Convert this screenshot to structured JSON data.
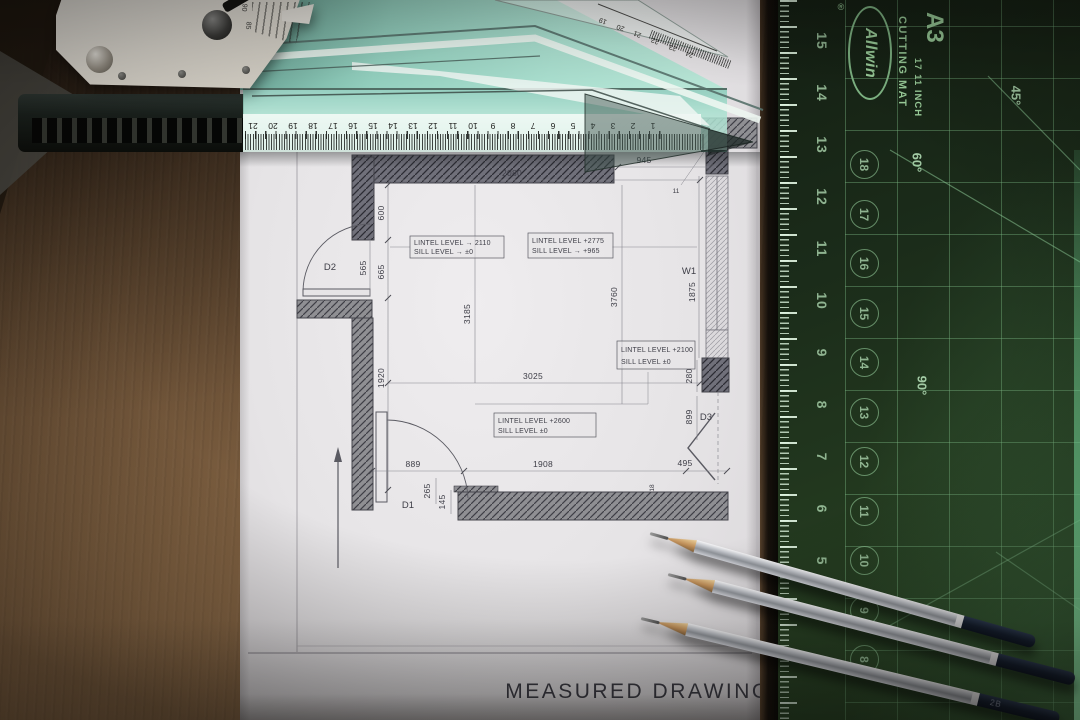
{
  "plan": {
    "title": "MEASURED DRAWING",
    "labels": {
      "d1": "D1",
      "d2": "D2",
      "d3": "D3",
      "w1": "W1"
    },
    "dims": {
      "top": "2080",
      "top_right": "945",
      "top_right_h": "575",
      "marker": "11",
      "left_a": "600",
      "left_b": "665",
      "door2_w": "565",
      "mid_v": "3185",
      "left_c": "1920",
      "mid_h": "3025",
      "right_v": "3760",
      "win_h": "1875",
      "col": "280",
      "d3_h": "899",
      "d3_w": "495",
      "bottom": "1908",
      "bottom_l": "889",
      "step_a": "265",
      "step_b": "145",
      "step_c": "18"
    },
    "boxes": {
      "b1l1": "LINTEL LEVEL → 2110",
      "b1l2": "SILL LEVEL → ±0",
      "b2l1": "LINTEL LEVEL +2775",
      "b2l2": "SILL LEVEL → +965",
      "b3l1": "LINTEL LEVEL +2100",
      "b3l2": "SILL LEVEL ±0",
      "b4l1": "LINTEL LEVEL +2600",
      "b4l2": "SILL LEVEL ±0"
    }
  },
  "ruler": {
    "numbers": [
      "21",
      "20",
      "19",
      "18",
      "17",
      "16",
      "15",
      "14",
      "13",
      "12",
      "11",
      "10",
      "9",
      "8",
      "7",
      "6",
      "5",
      "4",
      "3",
      "2",
      "1"
    ]
  },
  "square": {
    "numbers": [
      "19",
      "20",
      "21",
      "22",
      "23",
      "24"
    ]
  },
  "protractor": {
    "n_a": "90",
    "n_b": "85"
  },
  "mat": {
    "brand": "Allwin",
    "reg": "®",
    "label1": "CUTTING MAT",
    "label2": "17  11 INCH",
    "size": "A3",
    "edge_numbers": [
      "15",
      "14",
      "13",
      "12",
      "11",
      "10",
      "9",
      "8",
      "7",
      "6",
      "5",
      "4"
    ],
    "circled_numbers": [
      "18",
      "17",
      "16",
      "15",
      "14",
      "13",
      "12",
      "11",
      "10",
      "9",
      "8"
    ],
    "angle_45": "45°",
    "angle_60": "60°",
    "angle_90": "90°"
  },
  "pencil": {
    "grade": "2B"
  },
  "colors": {
    "mat_green": "#23402a",
    "grid_green": "#6fae79",
    "ruler_teal": "#a5dccd",
    "wood": "#6b4f33",
    "paper": "#e7e5e7"
  }
}
